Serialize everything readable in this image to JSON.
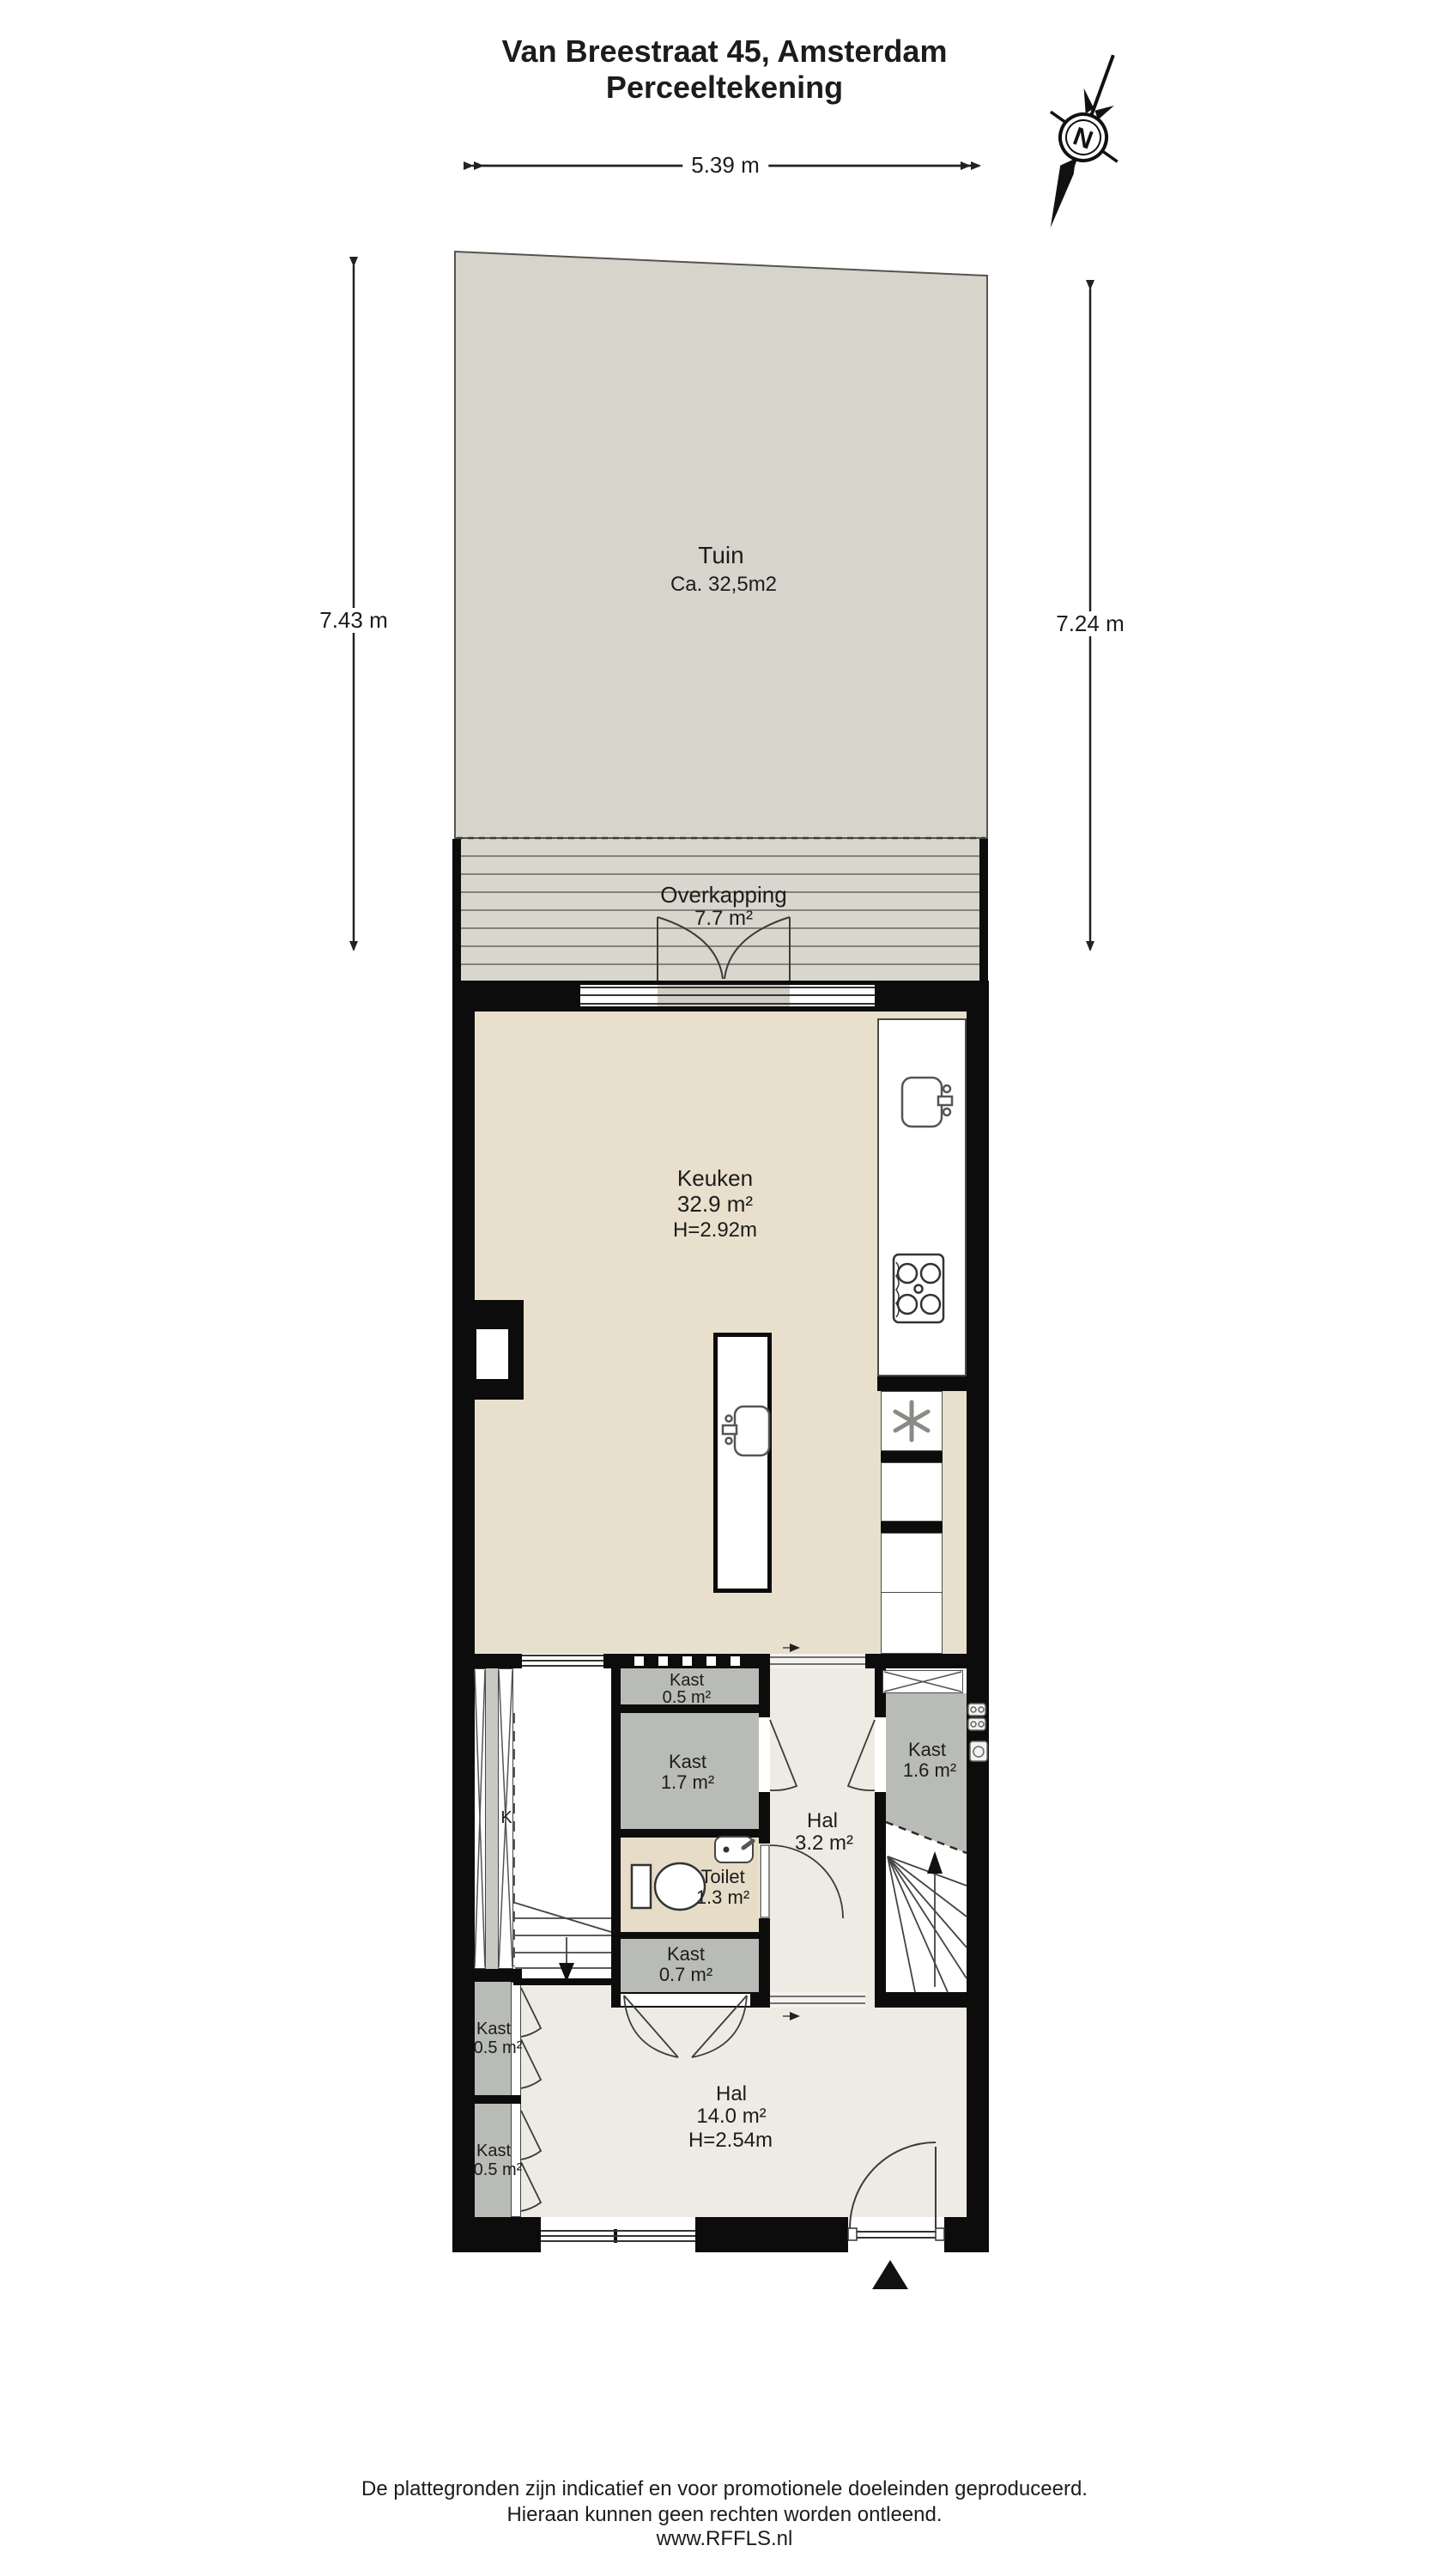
{
  "header": {
    "line1": "Van Breestraat 45, Amsterdam",
    "line2": "Perceeltekening"
  },
  "compass": {
    "letter": "N"
  },
  "dimensions": {
    "top": "5.39 m",
    "left": "7.43 m",
    "right": "7.24 m"
  },
  "rooms": {
    "tuin": {
      "name": "Tuin",
      "area": "Ca. 32,5m2"
    },
    "overkapping": {
      "name": "Overkapping",
      "area": "7.7 m²"
    },
    "keuken": {
      "name": "Keuken",
      "area": "32.9 m²",
      "height": "H=2.92m"
    },
    "kast_top": {
      "name": "Kast",
      "area": "0.5 m²"
    },
    "kast_17": {
      "name": "Kast",
      "area": "1.7 m²"
    },
    "toilet": {
      "name": "Toilet",
      "area": "1.3 m²"
    },
    "kast_07": {
      "name": "Kast",
      "area": "0.7 m²"
    },
    "hal_boven": {
      "name": "Hal",
      "area": "3.2 m²"
    },
    "kast_16": {
      "name": "Kast",
      "area": "1.6 m²"
    },
    "kast_links_1": {
      "name": "Kast",
      "area": "0.5 m²"
    },
    "kast_links_2": {
      "name": "Kast",
      "area": "0.5 m²"
    },
    "hal_beneden": {
      "name": "Hal",
      "area": "14.0 m²",
      "height": "H=2.54m"
    },
    "k_label": "K"
  },
  "footer": {
    "line1": "De plattegronden zijn indicatief en voor promotionele doeleinden geproduceerd.",
    "line2": "Hieraan kunnen geen rechten worden ontleend.",
    "line3": "www.RFFLS.nl"
  },
  "colors": {
    "wall": "#0c0c0c",
    "garden": "#d6d4cb",
    "kitchen_floor": "#e8e0cc",
    "hall_floor": "#edebe4",
    "closet_gray": "#b9bcb6",
    "toilet_floor": "#e7dcc7"
  }
}
